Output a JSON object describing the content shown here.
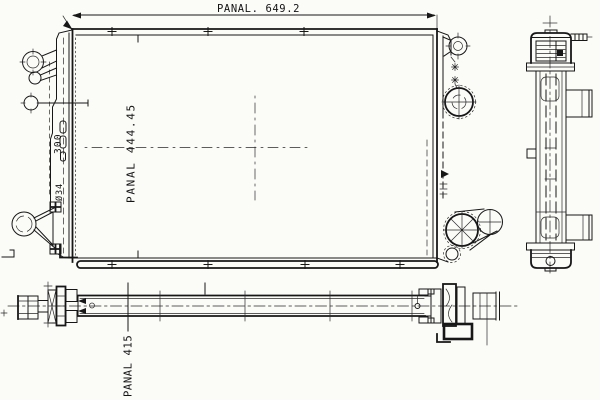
{
  "drawing": {
    "type": "radiator technical drawing",
    "background_color": "#fbfbf8",
    "line_color": "#171717",
    "views": {
      "front": {
        "name": "front view",
        "width_dimension": "PANAL. 649.2",
        "height_dimension": "PANAL 444.45",
        "offset_dimension": "300",
        "port_diameter": "Ø34"
      },
      "side": {
        "name": "side view"
      },
      "bottom": {
        "name": "bottom view",
        "depth_dimension": "PANAL 415"
      }
    }
  }
}
